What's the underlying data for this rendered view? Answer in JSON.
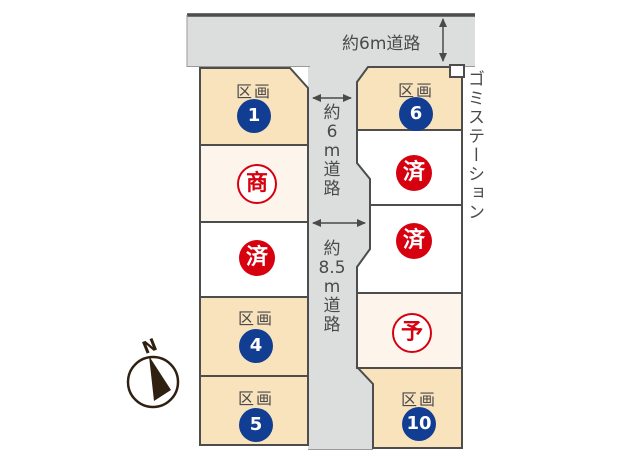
{
  "title": "lot-map",
  "colors": {
    "road_gray": "#dcdddd",
    "plot_beige": "#f8e3bd",
    "plot_cream": "#fdf5ec",
    "plot_white": "#ffffff",
    "border_dark": "#4d4d4d",
    "text_gray": "#4a4a4a",
    "number_blue": "#113e92",
    "status_red": "#d7000f",
    "compass_brown": "#2f2012"
  },
  "roads": {
    "top_label": "約6m道路",
    "vertical_6m_chars": [
      "約",
      "6",
      "m",
      "道",
      "路"
    ],
    "vertical_85m_chars": [
      "約",
      "8.5",
      "m",
      "道",
      "路"
    ]
  },
  "garbage_station_label": "ゴミステーション",
  "compass": {
    "north_label": "N"
  },
  "plots": [
    {
      "id": "1",
      "type": "numbered",
      "label": "区画",
      "number": "1"
    },
    {
      "id": "sho",
      "type": "status-outline",
      "status": "商"
    },
    {
      "id": "sumi-left",
      "type": "status-sold",
      "status": "済"
    },
    {
      "id": "4",
      "type": "numbered",
      "label": "区画",
      "number": "4"
    },
    {
      "id": "5",
      "type": "numbered",
      "label": "区画",
      "number": "5"
    },
    {
      "id": "6",
      "type": "numbered",
      "label": "区画",
      "number": "6"
    },
    {
      "id": "sumi-right-1",
      "type": "status-sold",
      "status": "済"
    },
    {
      "id": "sumi-right-2",
      "type": "status-sold",
      "status": "済"
    },
    {
      "id": "yo",
      "type": "status-outline",
      "status": "予"
    },
    {
      "id": "10",
      "type": "numbered",
      "label": "区画",
      "number": "10"
    }
  ]
}
